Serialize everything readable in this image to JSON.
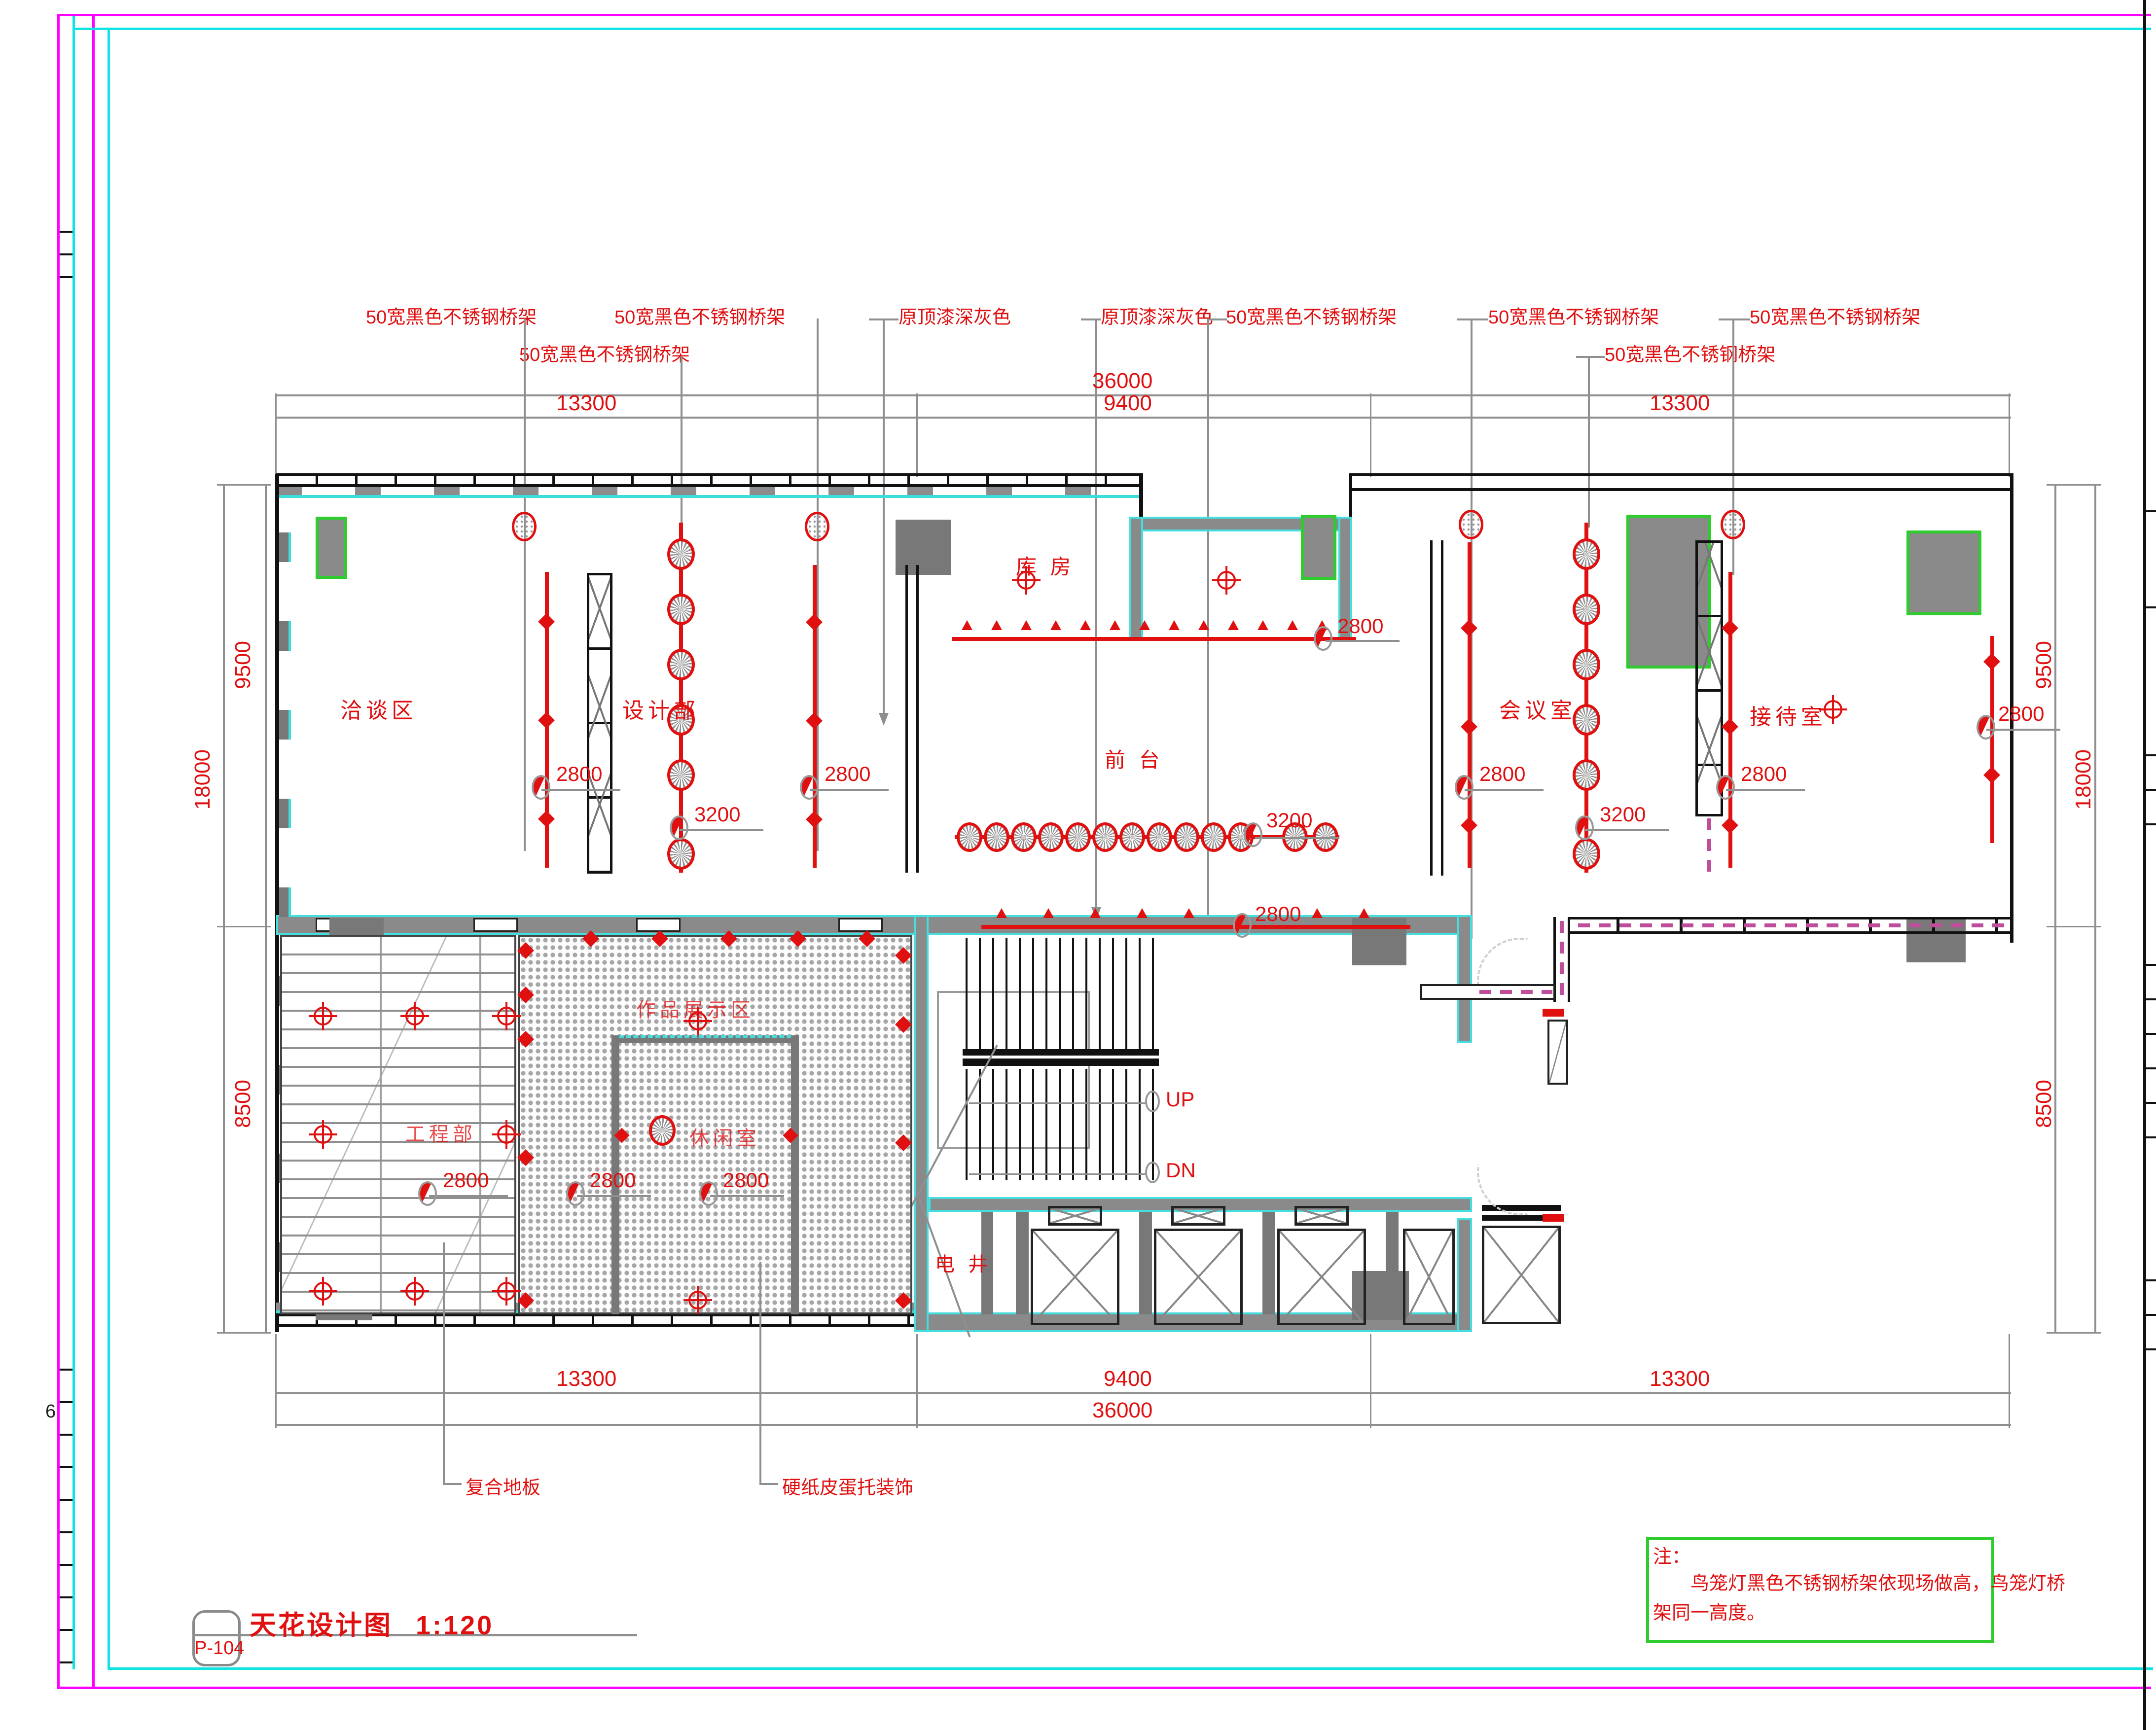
{
  "sheet": {
    "code": "P-104",
    "title": "天花设计图",
    "scale": "1:120",
    "index_char": "6"
  },
  "note": {
    "head": "注：",
    "line1": "　　鸟笼灯黑色不锈钢桥架依现场做高，鸟笼灯桥",
    "line2": "架同一高度。"
  },
  "callouts": {
    "tray": "50宽黑色不锈钢桥架",
    "ceiling_paint": "原顶漆深灰色",
    "floor": "复合地板",
    "egg_tray": "硬纸皮蛋托装饰"
  },
  "rooms": {
    "negotiation": "洽谈区",
    "design": "设计部",
    "storage": "库 房",
    "front_desk": "前 台",
    "meeting": "会议室",
    "reception": "接待室",
    "engineering": "工程部",
    "display_area": "作品展示区",
    "lounge": "休闲室",
    "shaft": "电 井"
  },
  "stairs": {
    "up": "UP",
    "down": "DN"
  },
  "dimensions": {
    "total_w": "36000",
    "left_w": "13300",
    "mid_w": "9400",
    "right_w": "13300",
    "total_h": "18000",
    "top_h": "9500",
    "bottom_h": "8500"
  },
  "elevations": {
    "h2800": "2800",
    "h3200": "3200"
  },
  "symbols": {
    "birdcage_lamp": "birdcage-lamp-icon",
    "downlight": "downlight-icon",
    "crosshair": "ceiling-target-icon",
    "tray_arrow": "cable-tray-arrow-icon"
  },
  "colors": {
    "annotation_red": "#e01010",
    "frame_magenta": "#ff00ff",
    "frame_cyan": "#0fe3e3",
    "note_green": "#2ecc2e",
    "wall_gray": "#8a8a8a"
  }
}
